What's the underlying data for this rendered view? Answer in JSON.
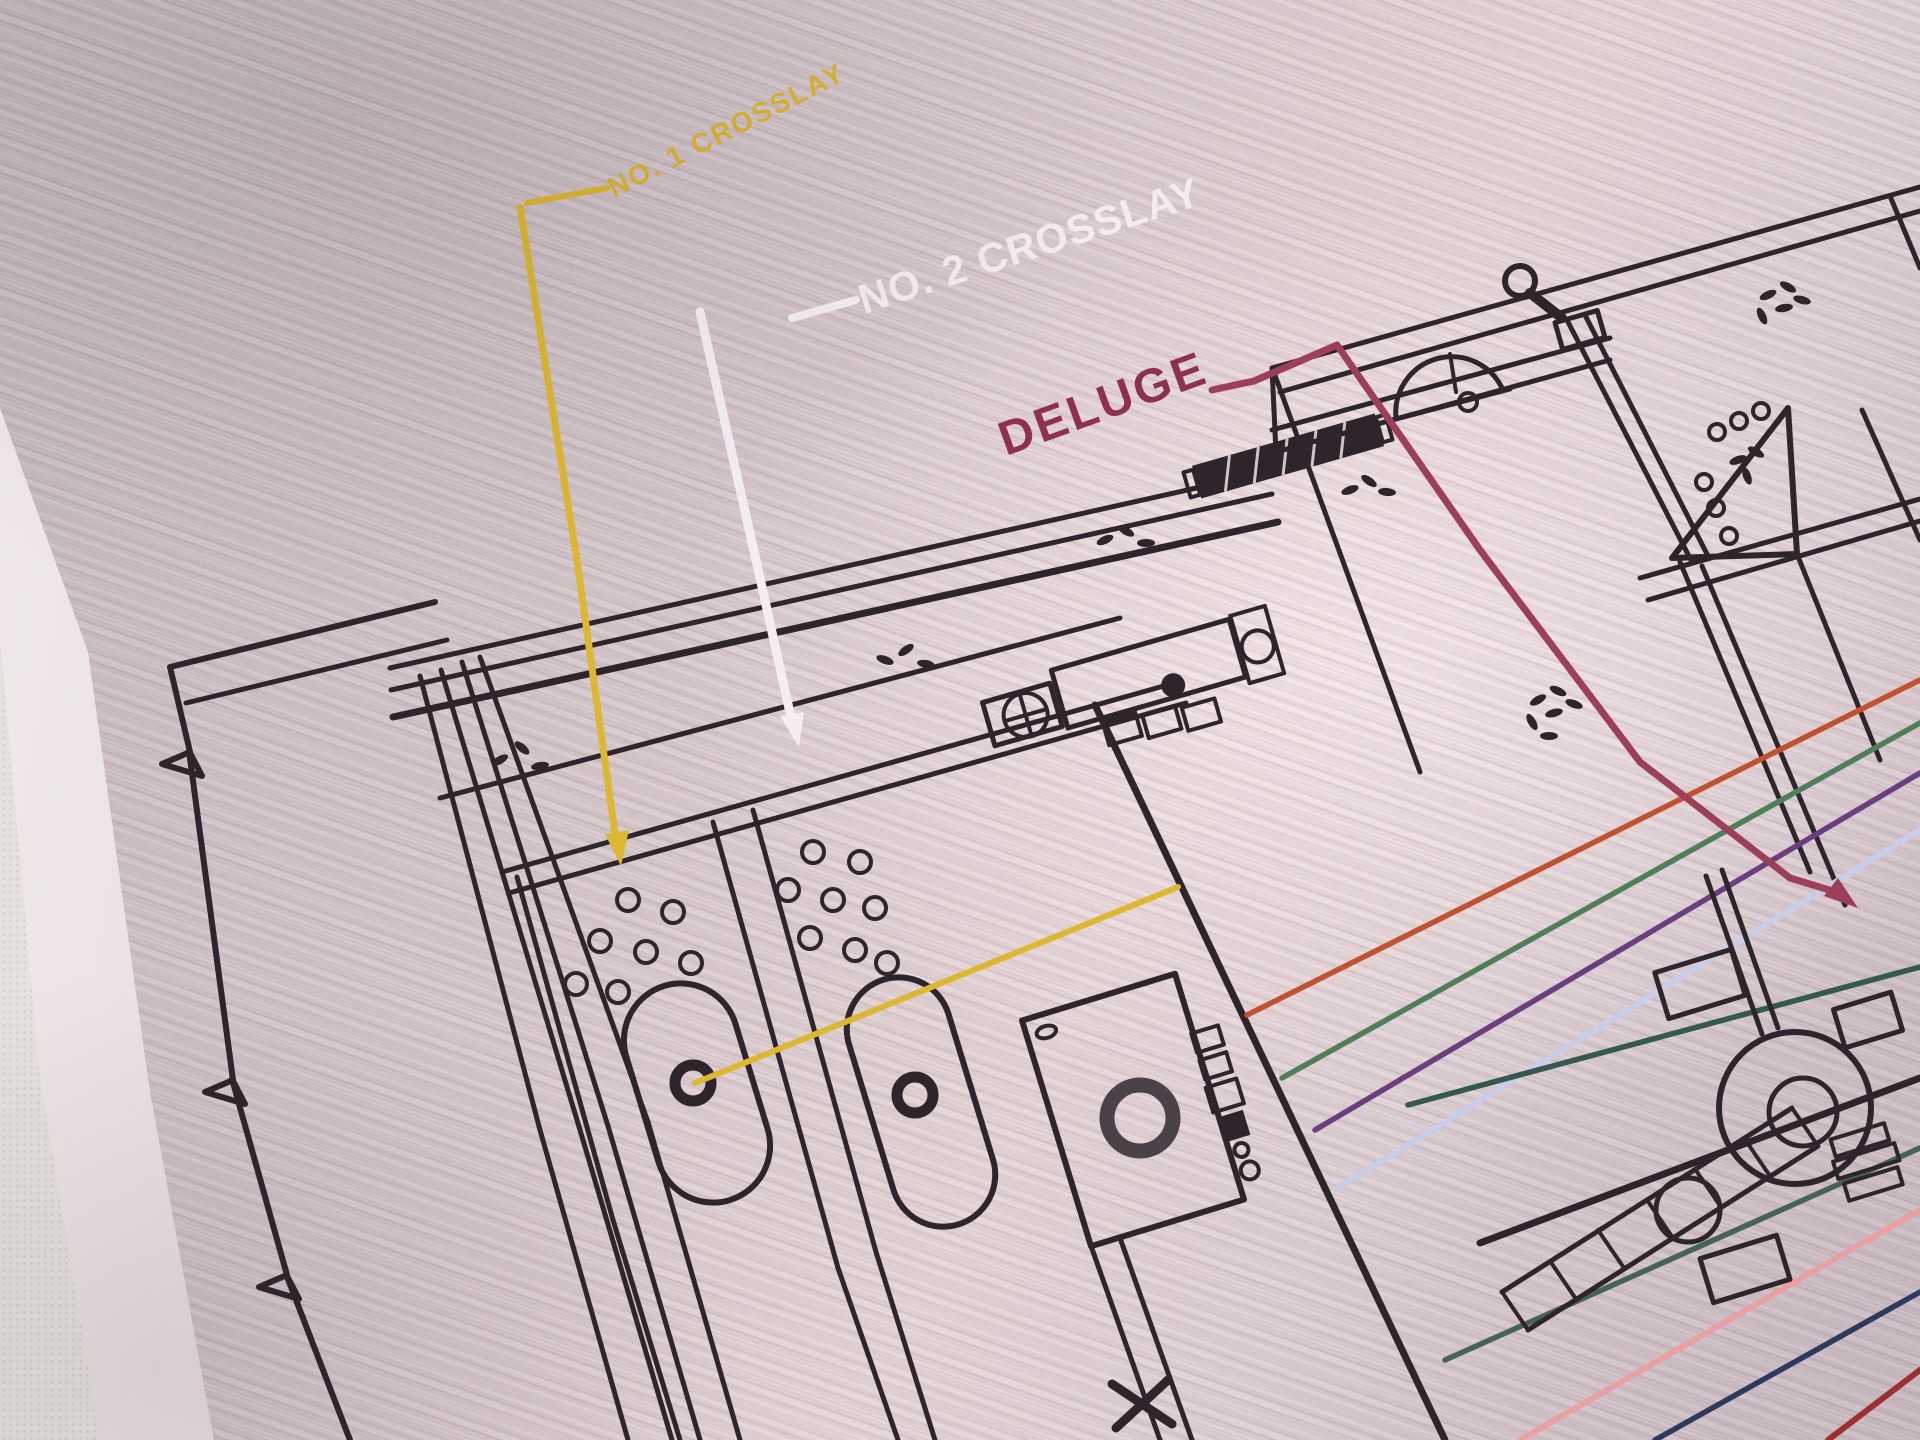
{
  "labels": {
    "crosslay1": {
      "text": "NO. 1 CROSSLAY",
      "color": "#d9b433"
    },
    "crosslay2": {
      "text": "NO. 2 CROSSLAY",
      "color": "#f3ebf0"
    },
    "deluge": {
      "text": "DELUGE",
      "color": "#8e3050"
    }
  },
  "colors": {
    "line_black": "#2e242b",
    "leader_yellow": "#dcb732",
    "leader_white": "#f4eef3",
    "leader_maroon": "#9c4059",
    "hose_yellow": "#dcb732",
    "hose_red": "#c2512f",
    "hose_green": "#4f7f58",
    "hose_purple": "#6b3f7d",
    "hose_lavender": "#c9cde8",
    "hose_teal": "#35594e",
    "hose_green2": "#466455",
    "hose_salmon": "#e9a0a2",
    "hose_navy": "#2d3a5c",
    "hose_darkred": "#9c2f2f"
  }
}
